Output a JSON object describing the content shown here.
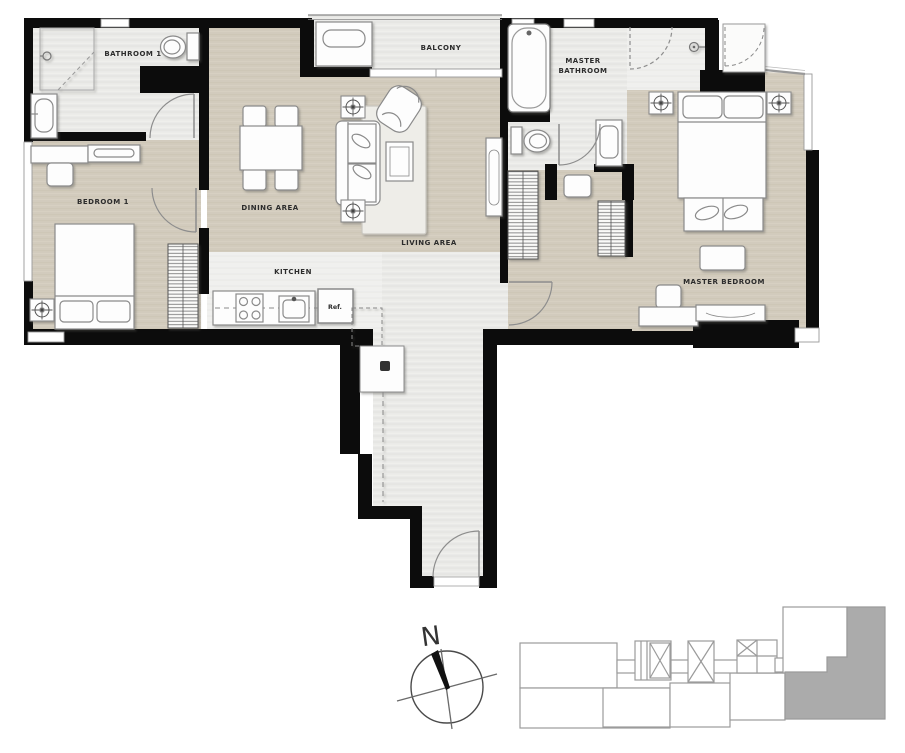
{
  "title": "Two-bedroom unit floor plan",
  "rooms": {
    "bathroom1": {
      "label": "BATHROOM 1"
    },
    "bedroom1": {
      "label": "BEDROOM 1"
    },
    "dining": {
      "label": "DINING AREA"
    },
    "living": {
      "label": "LIVING AREA"
    },
    "balcony": {
      "label": "BALCONY"
    },
    "master_bathroom": {
      "label_line1": "MASTER",
      "label_line2": "BATHROOM"
    },
    "kitchen": {
      "label": "KITCHEN"
    },
    "master_bedroom": {
      "label": "MASTER BEDROOM"
    }
  },
  "appliances": {
    "fridge_label": "Ref."
  },
  "compass": {
    "north_label": "N"
  },
  "colors": {
    "wall": "#0c0c0c",
    "floor_beige": "#d2cbbd",
    "floor_gray": "#eaeae8",
    "floor_pale": "#f3f3f1",
    "furniture_fill": "#fdfdfd",
    "furniture_stroke": "#8a8a8a",
    "door_arc": "#8d8d8d",
    "keyplan_stroke": "#9b9b9b",
    "keyplan_highlight": "#ababab",
    "label_text": "#2c2c2c"
  }
}
